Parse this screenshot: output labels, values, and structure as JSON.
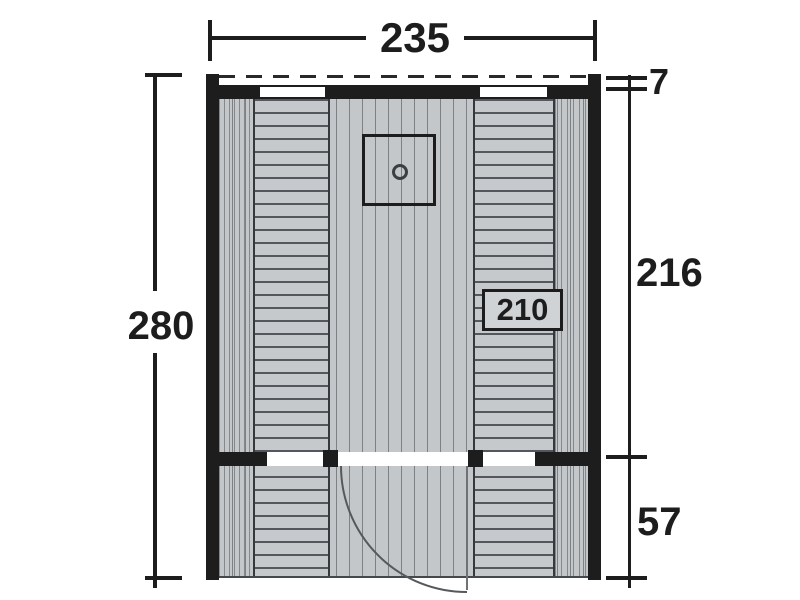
{
  "diagram": {
    "kind": "cabin-sauna-floor-plan",
    "dims": {
      "width": "235",
      "height": "280",
      "overhang": "7",
      "room_depth": "216",
      "porch_depth": "57"
    },
    "labels": {
      "bench_length": "210"
    },
    "colors": {
      "wall": "#1d1d1d",
      "floor": "#c4c7ca",
      "plank_line": "#7e8184",
      "bench_line": "#54575b",
      "label_box_fill": "#d0d3d6",
      "background": "#ffffff"
    },
    "symbols": [
      "stove",
      "door-swing",
      "windows",
      "benches",
      "roof-overhang-dashed"
    ]
  }
}
